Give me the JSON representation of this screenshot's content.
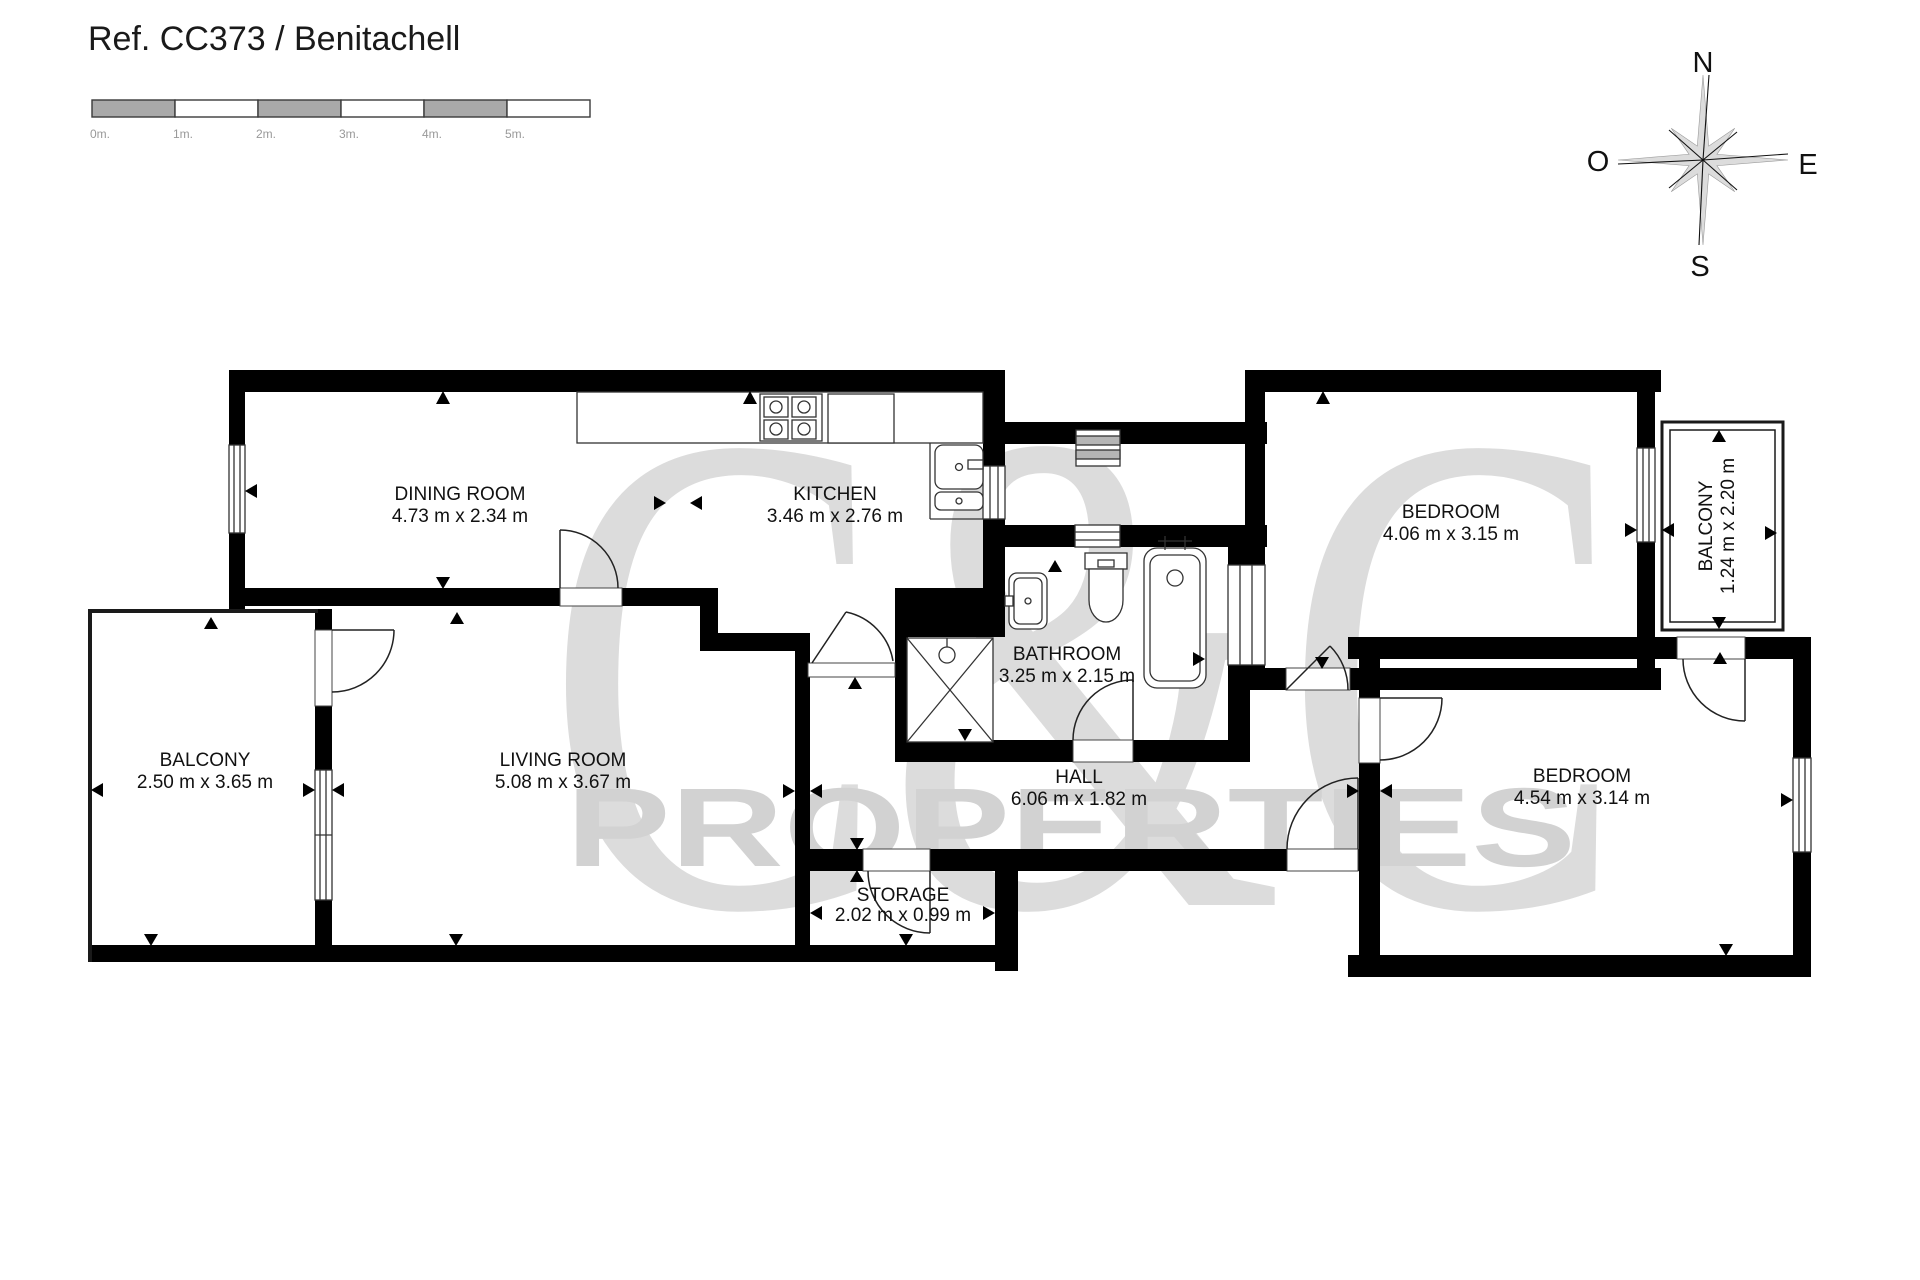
{
  "title": "Ref. CC373 / Benitachell",
  "scale_bar": {
    "labels": [
      "0m.",
      "1m.",
      "2m.",
      "3m.",
      "4m.",
      "5m."
    ]
  },
  "compass": {
    "north": "N",
    "south": "S",
    "east": "E",
    "west": "O"
  },
  "watermark": {
    "line1": "C&C",
    "line2": "PROPERTIES"
  },
  "rooms": [
    {
      "name": "DINING ROOM",
      "dims": "4.73 m x 2.34 m"
    },
    {
      "name": "KITCHEN",
      "dims": "3.46 m x 2.76 m"
    },
    {
      "name": "BATHROOM",
      "dims": "3.25 m x 2.15 m"
    },
    {
      "name": "BEDROOM",
      "dims": "4.06 m x 3.15 m"
    },
    {
      "name": "BALCONY",
      "dims": "1.24 m x 2.20 m"
    },
    {
      "name": "BALCONY",
      "dims": "2.50 m x 3.65 m"
    },
    {
      "name": "LIVING ROOM",
      "dims": "5.08 m x 3.67 m"
    },
    {
      "name": "HALL",
      "dims": "6.06 m x 1.82 m"
    },
    {
      "name": "STORAGE",
      "dims": "2.02 m x 0.99 m"
    },
    {
      "name": "BEDROOM",
      "dims": "4.54 m x 3.14 m"
    }
  ],
  "colors": {
    "wall": "#000000",
    "watermark": "#dcdcdc",
    "scale_gray": "#a9a9a9",
    "label_text": "#111111",
    "scale_label": "#999999"
  },
  "icons": {
    "compass": "compass-rose-icon",
    "stove": "stove-icon",
    "fridge": "refrigerator-icon",
    "sink": "kitchen-sink-icon",
    "washer": "washing-machine-icon",
    "washbasin": "washbasin-icon",
    "toilet": "toilet-icon",
    "bathtub": "bathtub-icon",
    "shower": "shower-icon"
  }
}
